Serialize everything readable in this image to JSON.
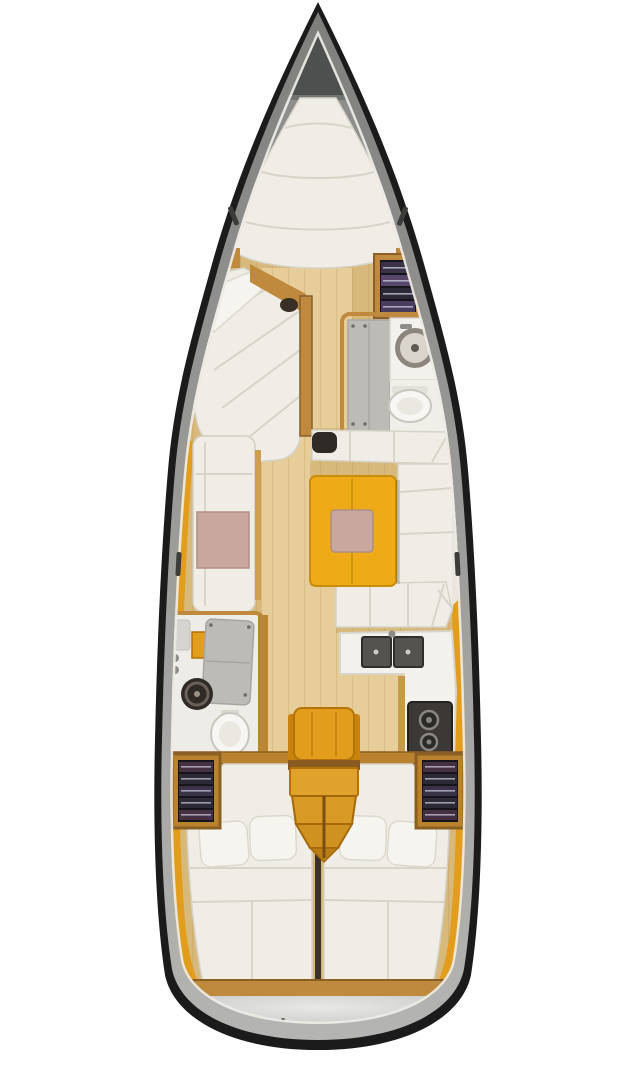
{
  "meta": {
    "title": "Sailing yacht interior floor plan — top-down view",
    "figure_type": "yacht-deck-plan"
  },
  "palette": {
    "page_bg": "#ffffff",
    "hull_outline": "#1b1b1b",
    "deck_rim": "#8f8f8d",
    "foredeck": "#8d8d8b",
    "anchor_locker": "#4e504f",
    "anchor_locker_outer": "#717371",
    "side_deck": "#eceae5",
    "mattress": "#efede5",
    "mattress_seam": "#d7d4c9",
    "pillow": "#f6f4ee",
    "wood_floor": "#d8b97c",
    "wood_floor_light": "#e6cd99",
    "wood_trim": "#c08a3e",
    "wood_trim_dark": "#8a5f2a",
    "amber_shelf": "#e29d1d",
    "amber_dark": "#b3720a",
    "steps_wood": "#e0a22c",
    "table_top": "#efab17",
    "table_edge": "#c78d0c",
    "cushion_pink": "#c8a79f",
    "cushion_pink_edge": "#b08e86",
    "counter_white": "#f2f1ec",
    "counter_edge": "#d8d5cc",
    "shower_gray": "#bcbbb6",
    "fixture_gray": "#8f8d88",
    "sink_dark": "#55534f",
    "basin_dark": "#2f2a26",
    "basin_ring": "#6a6059",
    "stove_dark": "#3b3835",
    "burner_gray": "#8a8783",
    "toilet_white": "#f7f6f2",
    "toilet_edge": "#c9c6be",
    "locker_frame": "#b9822e",
    "locker_interior": "#17151c",
    "clothes_a": "#453041",
    "clothes_b": "#2c2836",
    "clothes_c": "#3a3347",
    "clothes_d": "#57456a",
    "clothes_e": "#4a3c5c",
    "clothes_line": "#c3c6d6",
    "divider_dark": "#3c3126",
    "mast_dark": "#2e2a26",
    "window_slit": "#3c3c3a"
  },
  "regions": {
    "anchor_locker": {
      "label": "Anchor locker"
    },
    "v_berth": {
      "label": "Forward V-berth"
    },
    "forward_chaise": {
      "label": "Forward cabin chaise seat"
    },
    "forward_wardrobe": {
      "label": "Forward wardrobe shelves"
    },
    "forward_head": {
      "label": "Forward head — shower, washbasin and toilet"
    },
    "salon_port_settee": {
      "label": "Salon port settee"
    },
    "salon_u_settee": {
      "label": "Salon U-shaped settee"
    },
    "salon_table": {
      "label": "Salon table"
    },
    "mast": {
      "label": "Mast step"
    },
    "galley": {
      "label": "Galley — twin sinks and stove"
    },
    "aft_head": {
      "label": "Aft head — shower, washbasin and toilet"
    },
    "companionway": {
      "label": "Companionway steps"
    },
    "port_locker": {
      "label": "Port shelf locker"
    },
    "starboard_locker": {
      "label": "Starboard shelf locker"
    },
    "aft_berth_port": {
      "label": "Port aft double berth"
    },
    "aft_berth_starboard": {
      "label": "Starboard aft double berth"
    },
    "stern": {
      "label": "Transom and swim platform"
    }
  }
}
